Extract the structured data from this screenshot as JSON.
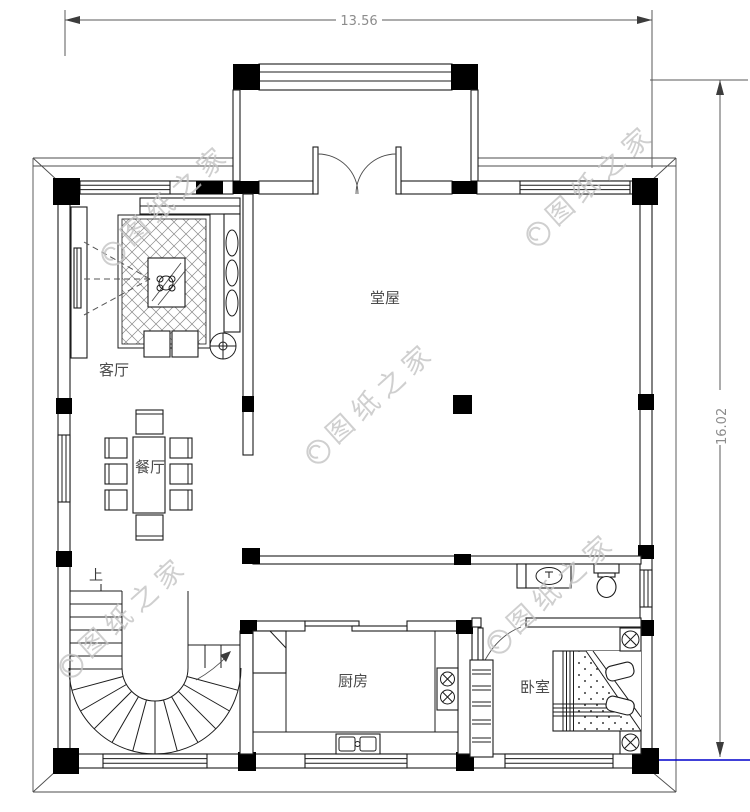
{
  "drawing": {
    "dimensions": {
      "width": "13.56",
      "height": "16.02"
    },
    "labels": {
      "main_hall": "堂屋",
      "living_room": "客厅",
      "dining_room": "餐厅",
      "kitchen": "厨房",
      "bedroom": "卧室",
      "stairs_up": "上"
    },
    "watermark": {
      "text": "图纸之家"
    },
    "colors": {
      "line": "#1c1c1c",
      "dimension_text": "#8c8c8c",
      "watermark": "#c4c4c4",
      "highlight_blue": "#0000cc"
    }
  }
}
